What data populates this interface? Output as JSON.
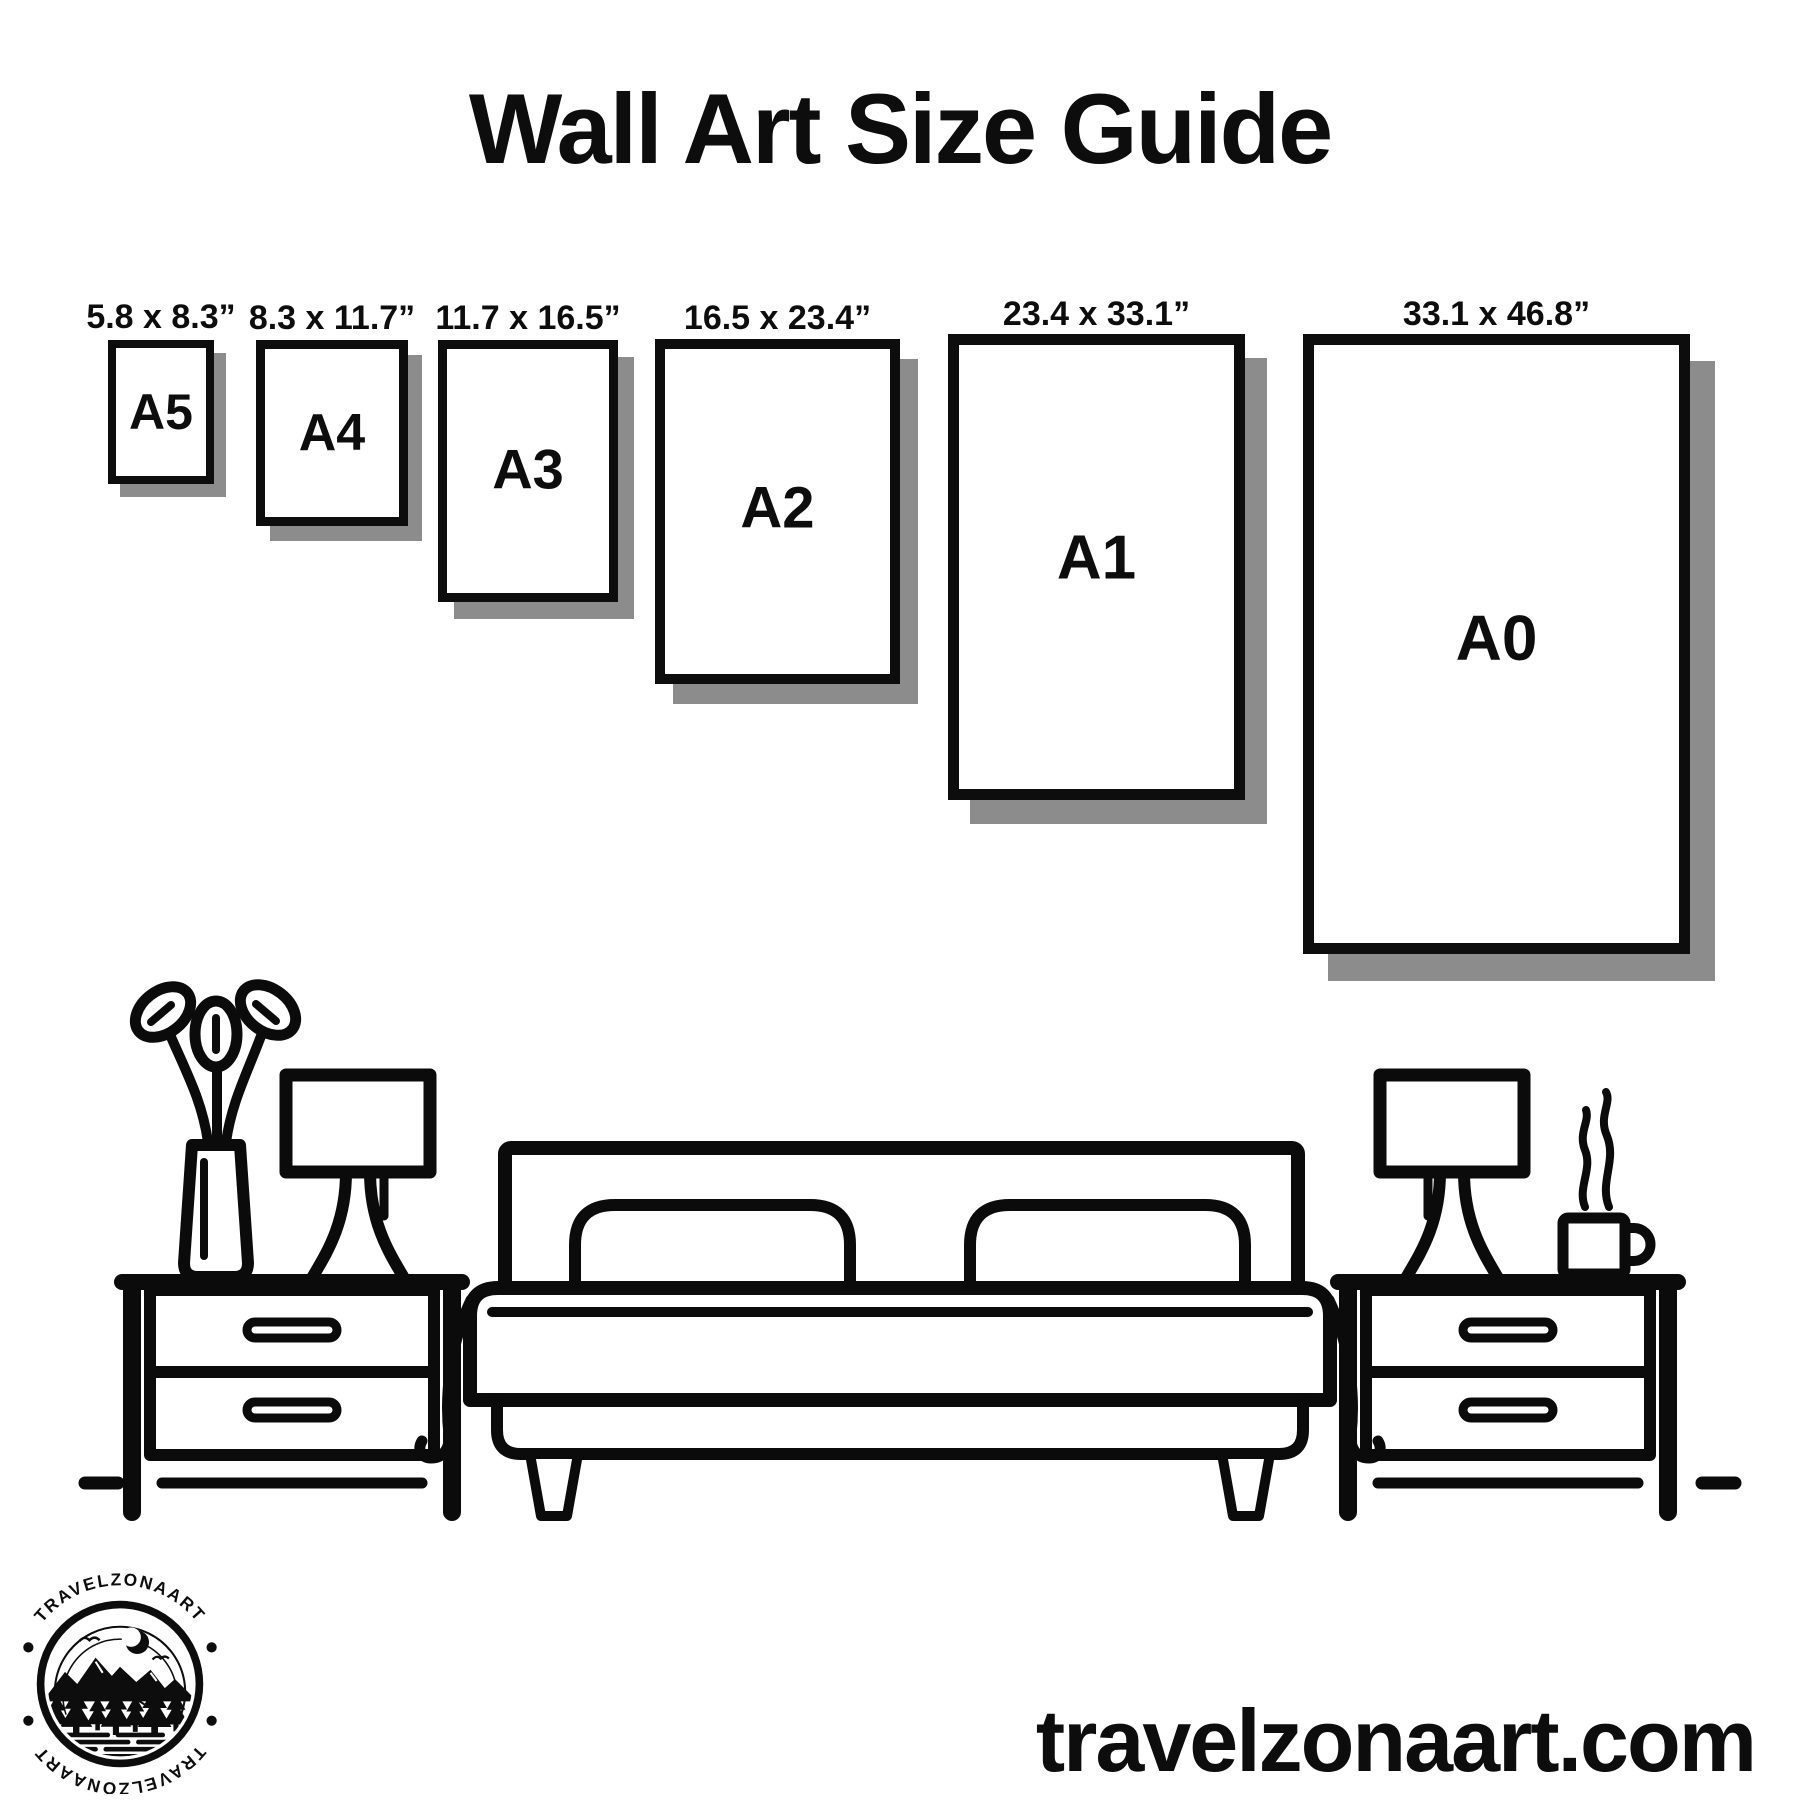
{
  "title": "Wall Art Size Guide",
  "sizes": [
    {
      "code": "A5",
      "dimensions": "5.8 x 8.3”"
    },
    {
      "code": "A4",
      "dimensions": "8.3 x 11.7”"
    },
    {
      "code": "A3",
      "dimensions": "11.7 x 16.5”"
    },
    {
      "code": "A2",
      "dimensions": "16.5 x 23.4”"
    },
    {
      "code": "A1",
      "dimensions": "23.4 x 33.1”"
    },
    {
      "code": "A0",
      "dimensions": "33.1 x 46.8”"
    }
  ],
  "logo": {
    "arc_text_top": "TRAVELZONAART",
    "arc_text_bottom": "TRAVELZONAART"
  },
  "website": "travelzonaart.com",
  "colors": {
    "ink": "#0d0d0d",
    "frame_shadow": "#8c8c8c",
    "background": "#ffffff"
  },
  "icons": [
    "plant-icon",
    "table-lamp-icon",
    "nightstand-icon",
    "bed-icon",
    "pillow-icon",
    "coffee-mug-icon",
    "steam-icon",
    "floor-line-icon",
    "mountain-badge-icon",
    "moon-icon",
    "pine-tree-icon",
    "bird-icon"
  ]
}
